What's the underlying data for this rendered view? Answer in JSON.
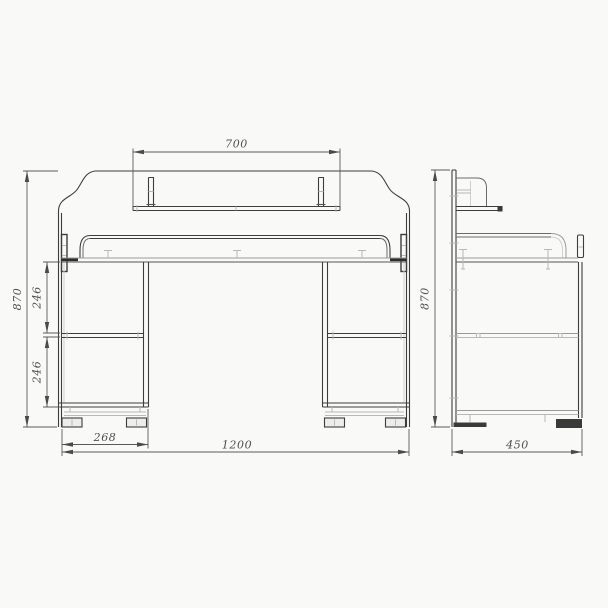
{
  "palette": {
    "background": "#f9f9f8",
    "main_line": "#3d3d3d",
    "light_line": "#b8b8b8",
    "dim_line": "#5a5a5a",
    "dim_text": "#4f4f4f"
  },
  "views": {
    "front": {
      "dims": {
        "shelf_width": "700",
        "height": "870",
        "upper_gap": "246",
        "lower_gap": "246",
        "pedestal_width": "268",
        "width": "1200"
      }
    },
    "side": {
      "dims": {
        "height": "870",
        "depth": "450"
      }
    }
  }
}
